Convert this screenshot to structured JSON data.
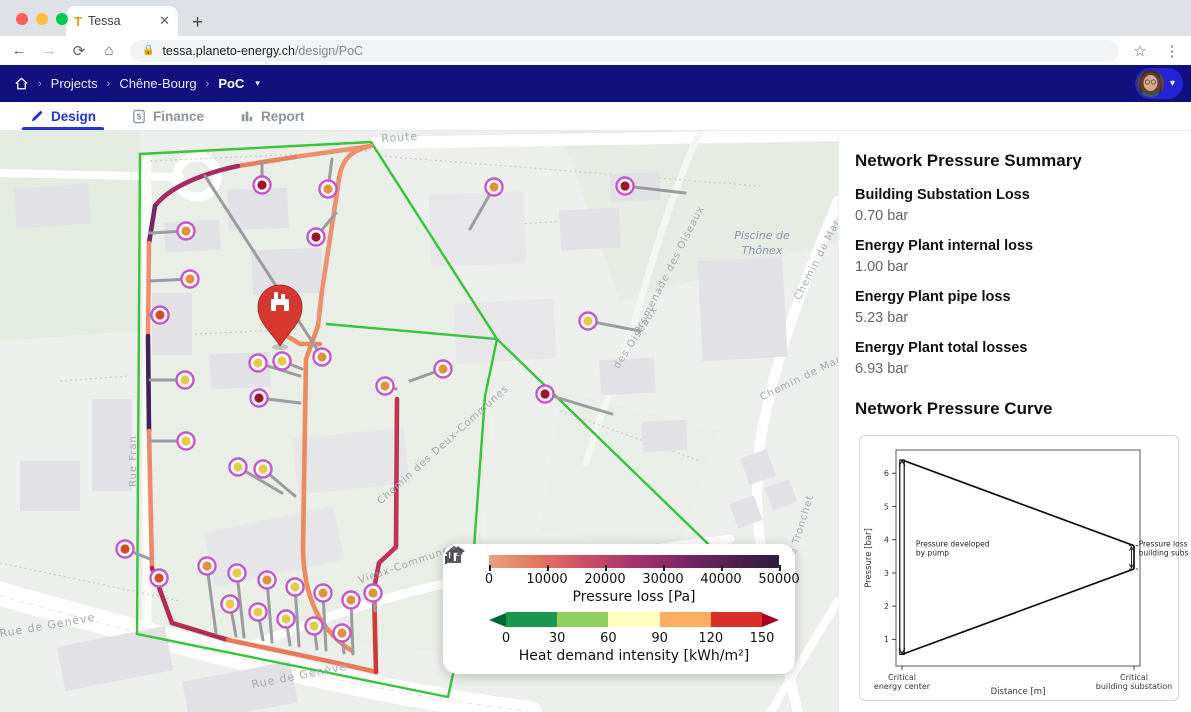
{
  "colors": {
    "nav_bar": "#10107e",
    "accent_blue": "#2533d0",
    "boundary_green": "#35c43a",
    "pin_red": "#d6372e",
    "node_ring": "#c558c9"
  },
  "browser": {
    "tab_title": "Tessa",
    "favicon_letter": "T",
    "close_glyph": "✕",
    "new_tab_glyph": "+",
    "url_host": "tessa.planeto-energy.ch",
    "url_path": "/design/PoC"
  },
  "breadcrumb": {
    "items": [
      "Projects",
      "Chêne-Bourg",
      "PoC"
    ]
  },
  "tabs": [
    {
      "label": "Design"
    },
    {
      "label": "Finance"
    },
    {
      "label": "Report"
    }
  ],
  "map": {
    "place": {
      "line1": "Piscine de",
      "line2": "Thônex"
    },
    "streets": [
      {
        "text": "Route",
        "x": 400,
        "y": 10,
        "r": -4,
        "s": 11
      },
      {
        "text": "Promenade des Oiseaux",
        "x": 672,
        "y": 140,
        "r": -63,
        "s": 10
      },
      {
        "text": "des Oiseaux",
        "x": 638,
        "y": 208,
        "r": -57,
        "s": 10
      },
      {
        "text": "Chemin de Mar",
        "x": 820,
        "y": 130,
        "r": -63,
        "s": 10
      },
      {
        "text": "Chemin de Mar",
        "x": 802,
        "y": 250,
        "r": -26,
        "s": 10
      },
      {
        "text": "Chemin des Deux-Communes",
        "x": 445,
        "y": 316,
        "r": -42,
        "s": 10
      },
      {
        "text": "Avenue Tronchet",
        "x": 799,
        "y": 412,
        "r": -73,
        "s": 10
      },
      {
        "text": "Rue Fran",
        "x": 136,
        "y": 330,
        "r": -90,
        "s": 10
      },
      {
        "text": "Rue de Genève",
        "x": 48,
        "y": 498,
        "r": -10,
        "s": 11
      },
      {
        "text": "Rue de Genève",
        "x": 300,
        "y": 548,
        "r": -11,
        "s": 11
      },
      {
        "text": "Rue de Genève",
        "x": 688,
        "y": 528,
        "r": -8,
        "s": 11
      },
      {
        "text": "Vieux-Communes",
        "x": 408,
        "y": 436,
        "r": -19,
        "s": 10
      }
    ],
    "legend": {
      "pressure": {
        "label": "Pressure loss [Pa]",
        "ticks": [
          "0",
          "10000",
          "20000",
          "30000",
          "40000",
          "50000"
        ],
        "gradient": [
          "#EDA07E",
          "#E2765D",
          "#CC4F68",
          "#A8336C",
          "#7C2766",
          "#51204F",
          "#2C1E3E"
        ]
      },
      "heat": {
        "label": "Heat demand intensity [kWh/m²]",
        "ticks": [
          "0",
          "30",
          "60",
          "90",
          "120",
          "150"
        ],
        "bins": [
          "#1a9850",
          "#91cf60",
          "#ffffbf",
          "#fdae61",
          "#d73027"
        ],
        "under": "#006837",
        "over": "#a50026"
      }
    }
  },
  "panel": {
    "summary_title": "Network Pressure Summary",
    "items": [
      {
        "label": "Building Substation Loss",
        "value": "0.70 bar"
      },
      {
        "label": "Energy Plant internal loss",
        "value": "1.00 bar"
      },
      {
        "label": "Energy Plant pipe loss",
        "value": "5.23 bar"
      },
      {
        "label": "Energy Plant total losses",
        "value": "6.93 bar"
      }
    ],
    "curve_title": "Network Pressure Curve"
  },
  "chart_data": {
    "type": "line",
    "title": "Network Pressure Curve",
    "xlabel": "Distance [m]",
    "ylabel": "Pressure [bar]",
    "ylim": [
      0.2,
      6.7
    ],
    "y_ticks": [
      1,
      2,
      3,
      4,
      5,
      6
    ],
    "x_tick_labels": [
      "Critical\nenergy center",
      "Critical\nbuilding substation"
    ],
    "series": [
      {
        "name": "supply",
        "x": [
          0,
          1
        ],
        "y": [
          6.4,
          3.82
        ]
      },
      {
        "name": "return",
        "x": [
          0,
          1
        ],
        "y": [
          0.55,
          3.12
        ]
      }
    ],
    "pump": {
      "x": 0,
      "from": 0.55,
      "to": 6.4
    },
    "substation_drop": {
      "x": 1,
      "from": 3.82,
      "to": 3.12
    },
    "annotations": [
      {
        "text": "Pressure developed\nby pump",
        "ax": 0.06,
        "ay": 3.8,
        "anchor": "start"
      },
      {
        "text": "Pressure loss\nbuilding substation",
        "ax": 1.02,
        "ay": 3.8,
        "anchor": "start"
      }
    ],
    "grid": false,
    "legend_position": "none"
  }
}
